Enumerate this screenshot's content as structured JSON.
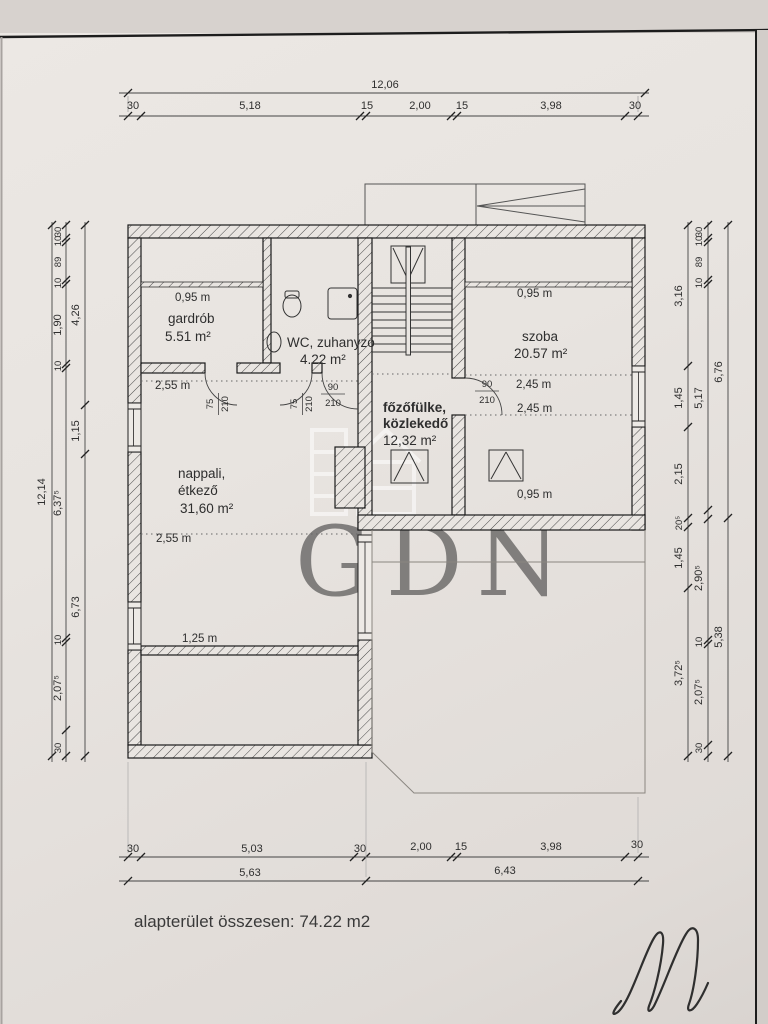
{
  "page": {
    "footer": "alapterület összesen: 74.22 m2",
    "watermark": "GDN"
  },
  "dims": {
    "top": {
      "total": "12,06",
      "segments": [
        "30",
        "5,18",
        "15",
        "2,00",
        "15",
        "3,98",
        "30"
      ]
    },
    "bottom": {
      "segments": [
        "30",
        "5,03",
        "30",
        "2,00",
        "15",
        "3,98",
        "30"
      ],
      "subtotals": [
        "5,63",
        "6,43"
      ]
    },
    "left": {
      "total": "12,14",
      "detail": [
        "30",
        "10",
        "89",
        "10",
        "1,90",
        "10",
        "6,37⁵",
        "10",
        "2,07⁵",
        "30"
      ],
      "subtotals": [
        "4,26",
        "1,15",
        "6,73"
      ]
    },
    "right": {
      "rooms": [
        "3,16",
        "1,45",
        "2,15",
        "20⁵",
        "1,45",
        "3,72⁵"
      ],
      "detail": [
        "30",
        "10",
        "89",
        "10",
        "5,17",
        "2,90⁵",
        "10",
        "2,07⁵",
        "30"
      ],
      "subtotals": [
        "6,76",
        "5,38"
      ]
    }
  },
  "rooms": {
    "gardrob": {
      "name": "gardrób",
      "area": "5.51 m²",
      "knee_height": "0,95 m"
    },
    "wc": {
      "name": "WC, zuhanyzó",
      "area": "4.22 m²"
    },
    "szoba": {
      "name": "szoba",
      "area": "20.57 m²",
      "knee_height": "0,95 m",
      "headroom1": "2,45 m",
      "headroom2": "2,45 m",
      "skylight": "0,95 m"
    },
    "fozofulke": {
      "name_line1": "főzőfülke,",
      "name_line2": "közlekedő",
      "area": "12,32 m²"
    },
    "nappali": {
      "name_line1": "nappali,",
      "name_line2": "étkező",
      "area": "31,60 m²",
      "headroom1": "2,55 m",
      "headroom2": "2,55 m",
      "low_wall": "1,25 m"
    }
  },
  "doors": {
    "gardrob": {
      "width": "75",
      "height": "210"
    },
    "wc": {
      "width": "75",
      "height": "210"
    },
    "fozofulke": {
      "width": "90",
      "height": "210"
    },
    "szoba": {
      "width": "90",
      "height": "210"
    }
  }
}
